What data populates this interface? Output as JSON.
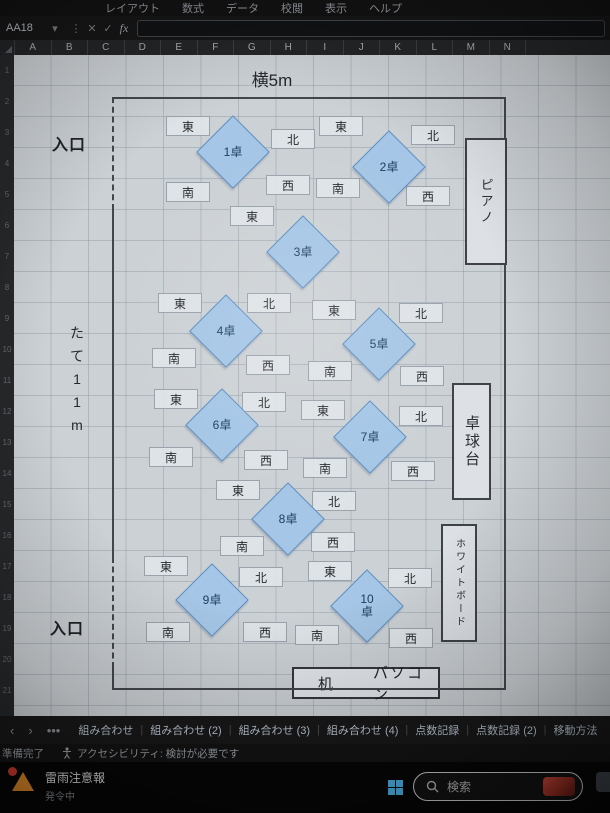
{
  "excel": {
    "menu_items": [
      "レイアウト",
      "数式",
      "データ",
      "校閲",
      "表示",
      "ヘルプ"
    ],
    "name_box": "AA18",
    "formula_icons": {
      "dropdown": "▾",
      "more": "⋮",
      "cancel": "✕",
      "enter": "✓",
      "fx": "fx"
    },
    "columns": [
      "A",
      "B",
      "C",
      "D",
      "E",
      "F",
      "G",
      "H",
      "I",
      "J",
      "K",
      "L",
      "M",
      "N"
    ],
    "row_numbers": [
      "1",
      "2",
      "3",
      "4",
      "5",
      "6",
      "7",
      "8",
      "9",
      "10",
      "11",
      "12",
      "13",
      "14",
      "15",
      "16",
      "17",
      "18",
      "19",
      "20",
      "21"
    ]
  },
  "diagram": {
    "title": "横5m",
    "side_label": "たて11m",
    "entrance_top": "入口",
    "entrance_bottom": "入口",
    "room": {
      "x": 112,
      "y": 97,
      "w": 394,
      "h": 593
    },
    "left_wall_segments": [
      {
        "y1": 97,
        "y2": 210,
        "style": "dashed"
      },
      {
        "y1": 210,
        "y2": 557,
        "style": "solid"
      },
      {
        "y1": 557,
        "y2": 668,
        "style": "dashed"
      },
      {
        "y1": 668,
        "y2": 690,
        "style": "solid"
      }
    ],
    "tables": [
      {
        "id": "1",
        "label": "1卓",
        "cx": 233,
        "cy": 152,
        "dirs": [
          {
            "d": "east",
            "label": "東",
            "cx": 188,
            "cy": 126
          },
          {
            "d": "north",
            "label": "北",
            "cx": 293,
            "cy": 139
          },
          {
            "d": "south",
            "label": "南",
            "cx": 188,
            "cy": 192
          },
          {
            "d": "west",
            "label": "西",
            "cx": 288,
            "cy": 185
          }
        ]
      },
      {
        "id": "2",
        "label": "2卓",
        "cx": 389,
        "cy": 167,
        "dirs": [
          {
            "d": "east",
            "label": "東",
            "cx": 341,
            "cy": 126
          },
          {
            "d": "north",
            "label": "北",
            "cx": 433,
            "cy": 135
          },
          {
            "d": "south",
            "label": "南",
            "cx": 338,
            "cy": 188
          },
          {
            "d": "west",
            "label": "西",
            "cx": 428,
            "cy": 196
          }
        ]
      },
      {
        "id": "3",
        "label": "3卓",
        "cx": 303,
        "cy": 252,
        "dirs": [
          {
            "d": "east",
            "label": "東",
            "cx": 252,
            "cy": 216
          }
        ]
      },
      {
        "id": "4",
        "label": "4卓",
        "cx": 226,
        "cy": 331,
        "dirs": [
          {
            "d": "east",
            "label": "東",
            "cx": 180,
            "cy": 303
          },
          {
            "d": "north",
            "label": "北",
            "cx": 269,
            "cy": 303
          },
          {
            "d": "south",
            "label": "南",
            "cx": 174,
            "cy": 358
          },
          {
            "d": "west",
            "label": "西",
            "cx": 268,
            "cy": 365
          }
        ]
      },
      {
        "id": "5",
        "label": "5卓",
        "cx": 379,
        "cy": 344,
        "dirs": [
          {
            "d": "east",
            "label": "東",
            "cx": 334,
            "cy": 310
          },
          {
            "d": "north",
            "label": "北",
            "cx": 421,
            "cy": 313
          },
          {
            "d": "south",
            "label": "南",
            "cx": 330,
            "cy": 371
          },
          {
            "d": "west",
            "label": "西",
            "cx": 422,
            "cy": 376
          }
        ]
      },
      {
        "id": "6",
        "label": "6卓",
        "cx": 222,
        "cy": 425,
        "dirs": [
          {
            "d": "east",
            "label": "東",
            "cx": 176,
            "cy": 399
          },
          {
            "d": "north",
            "label": "北",
            "cx": 264,
            "cy": 402
          },
          {
            "d": "south",
            "label": "南",
            "cx": 171,
            "cy": 457
          },
          {
            "d": "west",
            "label": "西",
            "cx": 266,
            "cy": 460
          }
        ]
      },
      {
        "id": "7",
        "label": "7卓",
        "cx": 370,
        "cy": 437,
        "dirs": [
          {
            "d": "east",
            "label": "東",
            "cx": 323,
            "cy": 410
          },
          {
            "d": "north",
            "label": "北",
            "cx": 421,
            "cy": 416
          },
          {
            "d": "south",
            "label": "南",
            "cx": 325,
            "cy": 468
          },
          {
            "d": "west",
            "label": "西",
            "cx": 413,
            "cy": 471
          }
        ]
      },
      {
        "id": "8",
        "label": "8卓",
        "cx": 288,
        "cy": 519,
        "dirs": [
          {
            "d": "east",
            "label": "東",
            "cx": 238,
            "cy": 490
          },
          {
            "d": "north",
            "label": "北",
            "cx": 334,
            "cy": 501
          },
          {
            "d": "south",
            "label": "南",
            "cx": 242,
            "cy": 546
          },
          {
            "d": "west",
            "label": "西",
            "cx": 333,
            "cy": 542
          }
        ]
      },
      {
        "id": "9",
        "label": "9卓",
        "cx": 212,
        "cy": 600,
        "dirs": [
          {
            "d": "east",
            "label": "東",
            "cx": 166,
            "cy": 566
          },
          {
            "d": "north",
            "label": "北",
            "cx": 261,
            "cy": 577
          },
          {
            "d": "south",
            "label": "南",
            "cx": 168,
            "cy": 632
          },
          {
            "d": "west",
            "label": "西",
            "cx": 265,
            "cy": 632
          }
        ]
      },
      {
        "id": "10",
        "label": "10\n卓",
        "cx": 367,
        "cy": 606,
        "dirs": [
          {
            "d": "east",
            "label": "東",
            "cx": 330,
            "cy": 571
          },
          {
            "d": "north",
            "label": "北",
            "cx": 410,
            "cy": 578
          },
          {
            "d": "south",
            "label": "南",
            "cx": 317,
            "cy": 635
          },
          {
            "d": "west",
            "label": "西",
            "cx": 411,
            "cy": 638
          }
        ]
      }
    ],
    "furniture": [
      {
        "name": "piano",
        "label": "ピアノ",
        "x": 465,
        "y": 138,
        "w": 42,
        "h": 127,
        "fs": 13
      },
      {
        "name": "table-tennis",
        "label": "卓球台",
        "x": 452,
        "y": 383,
        "w": 39,
        "h": 117,
        "fs": 15
      },
      {
        "name": "whiteboard",
        "label": "ホワイトボード",
        "x": 441,
        "y": 524,
        "w": 36,
        "h": 118,
        "fs": 10
      }
    ],
    "desk": {
      "label_left": "机",
      "label_right": "パソコン",
      "x": 292,
      "y": 667,
      "w": 148,
      "h": 32
    }
  },
  "sheet_tabs": {
    "nav_prev": "‹",
    "nav_next": "›",
    "nav_more": "•••",
    "tabs": [
      "組み合わせ",
      "組み合わせ (2)",
      "組み合わせ (3)",
      "組み合わせ (4)",
      "点数記録",
      "点数記録 (2)",
      "移動方法"
    ]
  },
  "status_bar": {
    "ready": "準備完了",
    "accessibility": "アクセシビリティ: 検討が必要です"
  },
  "taskbar": {
    "weather_title": "雷雨注意報",
    "weather_sub": "発令中",
    "search_placeholder": "検索"
  },
  "colors": {
    "diamond_fill": "#a5c6e6",
    "diamond_border": "#5e8fc0",
    "taskbar_accent": "#47b1e8",
    "weather_alert": "#e08a28"
  }
}
